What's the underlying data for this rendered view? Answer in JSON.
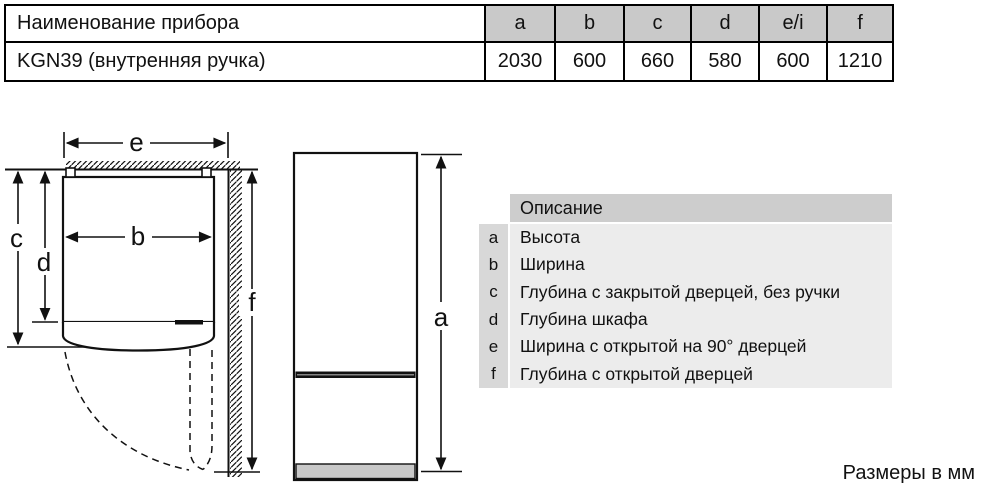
{
  "table": {
    "header": {
      "name_label": "Наименование прибора",
      "columns": [
        "a",
        "b",
        "c",
        "d",
        "e/i",
        "f"
      ]
    },
    "row": {
      "model": "KGN39 (внутренняя ручка)",
      "values": [
        "2030",
        "600",
        "660",
        "580",
        "600",
        "1210"
      ]
    }
  },
  "legend": {
    "title": "Описание",
    "items": [
      {
        "key": "a",
        "label": "Высота"
      },
      {
        "key": "b",
        "label": "Ширина"
      },
      {
        "key": "c",
        "label": "Глубина с закрытой дверцей, без ручки"
      },
      {
        "key": "d",
        "label": "Глубина шкафа"
      },
      {
        "key": "e",
        "label": "Ширина с открытой на 90° дверцей"
      },
      {
        "key": "f",
        "label": "Глубина с открытой дверцей"
      }
    ]
  },
  "diagram": {
    "labels": {
      "a": "a",
      "b": "b",
      "c": "c",
      "d": "d",
      "e": "e",
      "f": "f"
    }
  },
  "footer": {
    "units_note": "Размеры в мм"
  },
  "colors": {
    "table_header_bg": "#c9c9c9",
    "legend_title_bg": "#cdcdcd",
    "legend_key_bg": "#d8d8d8",
    "legend_row_bg": "#ececec",
    "plinth_fill": "#c8c8c8",
    "line": "#111111"
  }
}
